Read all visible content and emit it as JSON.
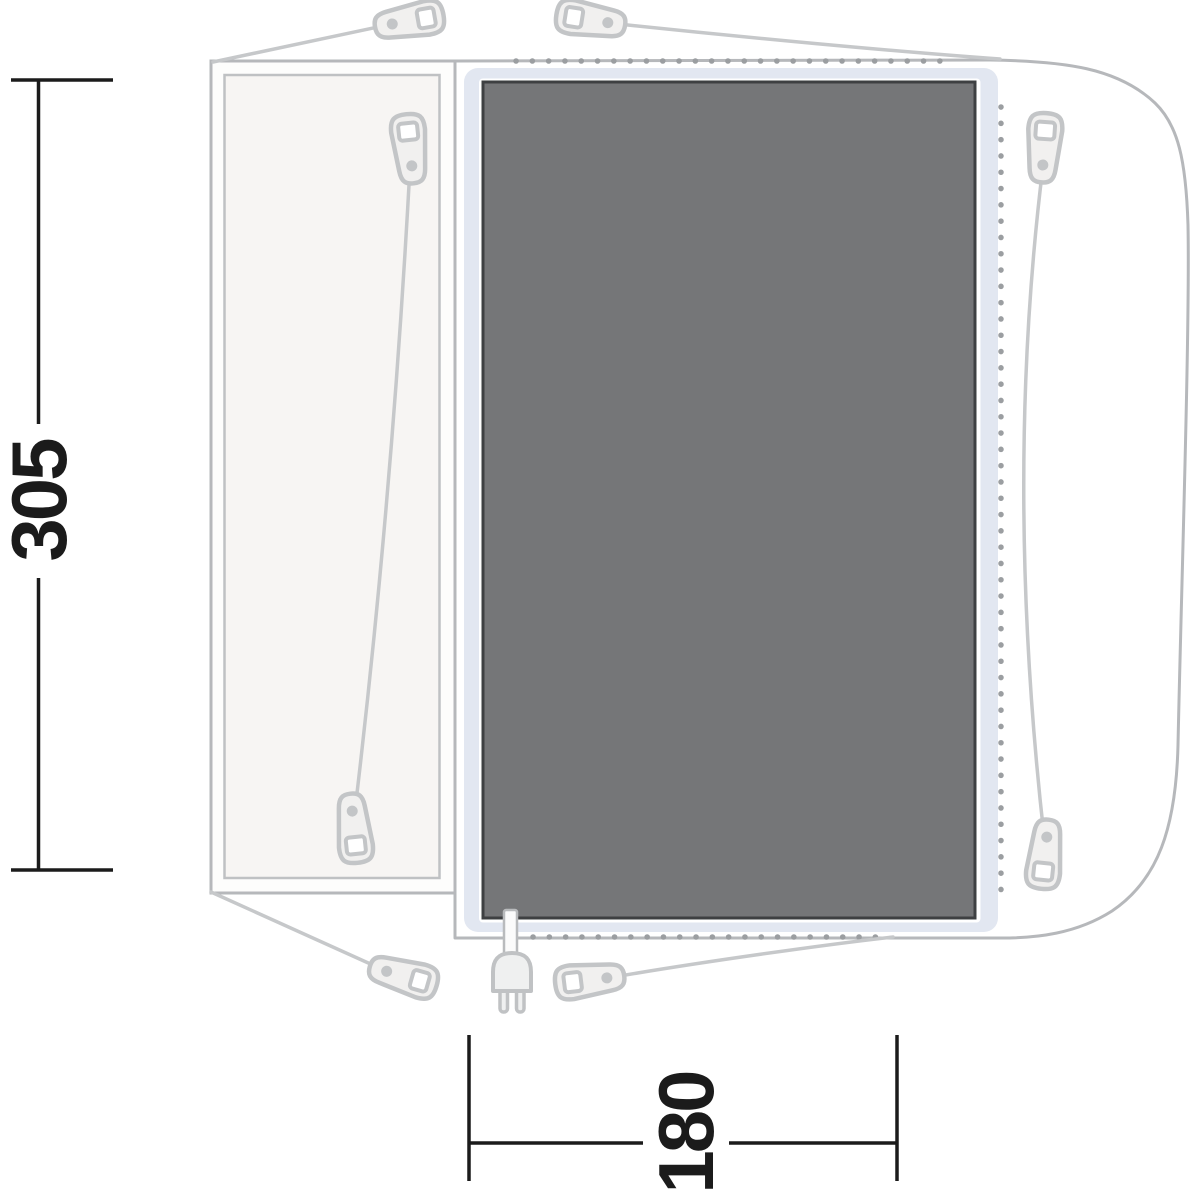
{
  "diagram": {
    "kind": "tent-footprint-floorplan",
    "dimensions": {
      "depth": {
        "value": "305",
        "orientation": "rotated-90-ccw",
        "position": "left"
      },
      "width": {
        "value": "180",
        "orientation": "rotated-90-ccw",
        "position": "bottom"
      }
    },
    "icons": [
      "peg-loop-icon (x8, teardrop with square hole and rivet dot)",
      "guy-rope-line",
      "power-plug-icon (two prongs, cable into groundsheet)",
      "dotted-peg-line (top, right, bottom)"
    ],
    "colors": {
      "groundsheet_fill": "#757678",
      "groundsheet_border": "#3e4042",
      "underlay_blue": "#e2e7f1",
      "outline_gray": "#b6b8bb",
      "inner_panel_stroke": "#bfc1c3",
      "porch_fill": "#f7f5f3",
      "peg_stroke": "#c3c5c7",
      "peg_fill": "#f1f0ef",
      "rope_gray": "#c6c8ca",
      "dot_gray": "#9b9ea1",
      "dimension_black": "#1b1b1b",
      "background": "#ffffff"
    }
  }
}
